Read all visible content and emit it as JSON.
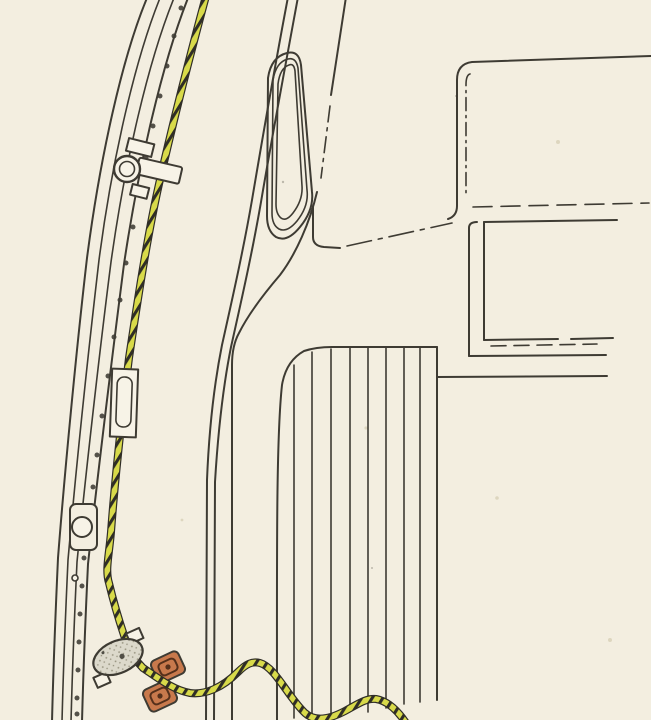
{
  "figure": {
    "kind": "technical-line-illustration",
    "description": "Vintage vehicle-body line drawing: a yellow twisted cable routed along the curved door-aperture flange, held by a clamp, passing through a guide sleeve, around a grey tensioner fitting and between two orange rubber blocks, then snaking over a ribbed panel; window frames sketched at right.",
    "colors": {
      "paper": "#f3eee0",
      "paper_bright": "#f7f3e7",
      "ink": "#3e3b33",
      "cable_yellow": "#d8da4a",
      "cable_dark": "#2f2d26",
      "block_orange": "#c8794c",
      "block_inner": "#55301b",
      "fitting_gray": "#dcd9cb",
      "stipple": "#96927e",
      "speck": "#ddd6bf"
    },
    "parts": [
      "aperture-flange-track",
      "rivet-holes",
      "latch-hole-feature",
      "cable-clamp",
      "guide-sleeve",
      "striped-cable",
      "tensioner-fitting",
      "rubber-block-upper",
      "rubber-block-lower",
      "b-pillar",
      "vent-slot",
      "belt-line",
      "ribbed-panel",
      "window-frame-upper",
      "window-frame-lower"
    ]
  }
}
